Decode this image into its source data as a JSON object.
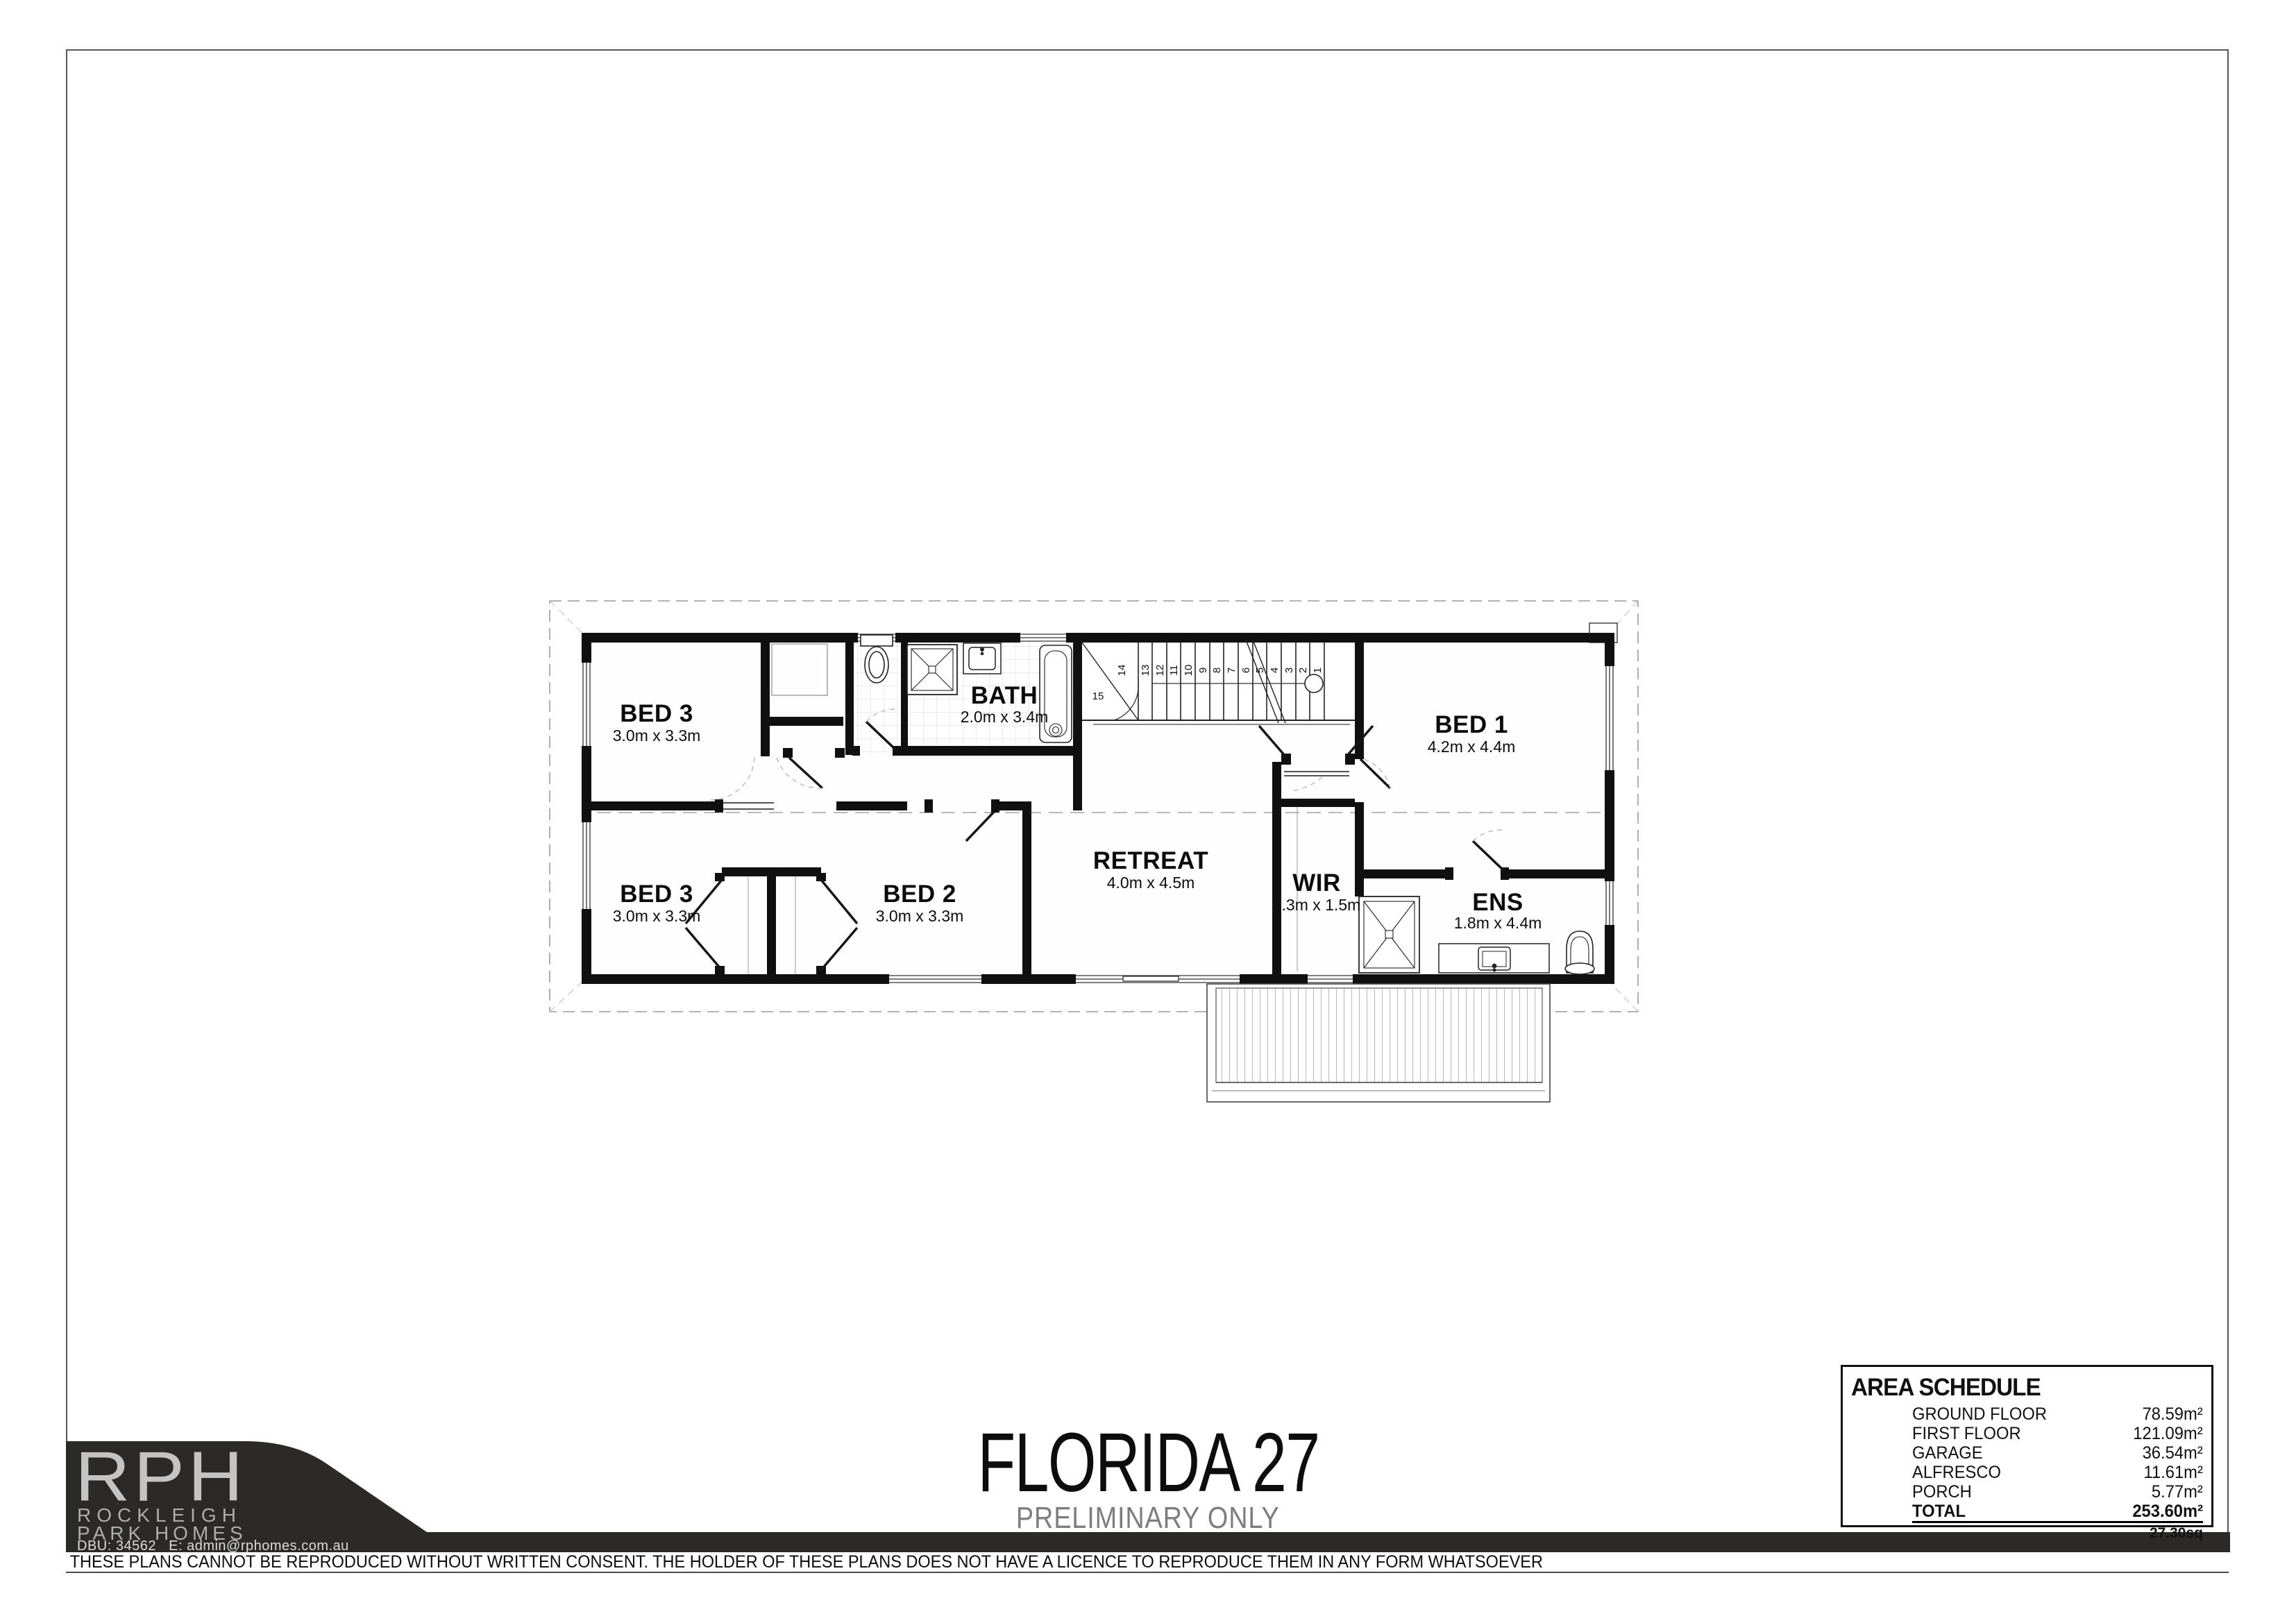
{
  "colors": {
    "ink": "#111111",
    "logo_background": "#2b2a29",
    "logo_letters": "#c4c4c4",
    "subtitle_gray": "#7d7d7d",
    "roof_dash": "#9a9a9a"
  },
  "title_block": {
    "title": "FLORIDA 27",
    "subtitle": "PRELIMINARY ONLY"
  },
  "logo": {
    "initials": "RPH",
    "line1": "ROCKLEIGH",
    "line2": "PARK HOMES",
    "dbu_line": "DBU: 34562   E: admin@rphomes.com.au"
  },
  "disclaimer": "THESE PLANS CANNOT BE REPRODUCED WITHOUT WRITTEN CONSENT. THE HOLDER OF THESE PLANS DOES NOT HAVE A LICENCE TO REPRODUCE THEM IN ANY FORM WHATSOEVER",
  "area_schedule": {
    "title": "AREA SCHEDULE",
    "rows": [
      {
        "label": "GROUND FLOOR",
        "value": "78.59m²"
      },
      {
        "label": "FIRST FLOOR",
        "value": "121.09m²"
      },
      {
        "label": "GARAGE",
        "value": "36.54m²"
      },
      {
        "label": "ALFRESCO",
        "value": "11.61m²"
      },
      {
        "label": "PORCH",
        "value": "5.77m²"
      }
    ],
    "total": {
      "label": "TOTAL",
      "value": "253.60m²"
    },
    "total_squares": "27.30sq"
  },
  "plan": {
    "rooms": [
      {
        "name": "BED 3",
        "dims": "3.0m x 3.3m"
      },
      {
        "name": "BATH",
        "dims": "2.0m x 3.4m"
      },
      {
        "name": "BED 3",
        "dims": "3.0m x 3.3m"
      },
      {
        "name": "BED 2",
        "dims": "3.0m x 3.3m"
      },
      {
        "name": "RETREAT",
        "dims": "4.0m x 4.5m"
      },
      {
        "name": "WIR",
        "dims": "3.3m x 1.5m"
      },
      {
        "name": "BED 1",
        "dims": "4.2m x 4.4m"
      },
      {
        "name": "ENS",
        "dims": "1.8m x 4.4m"
      }
    ],
    "stairs": {
      "numbers": [
        "1",
        "2",
        "3",
        "4",
        "5",
        "6",
        "7",
        "8",
        "9",
        "10",
        "11",
        "12",
        "13",
        "14",
        "15"
      ]
    }
  }
}
